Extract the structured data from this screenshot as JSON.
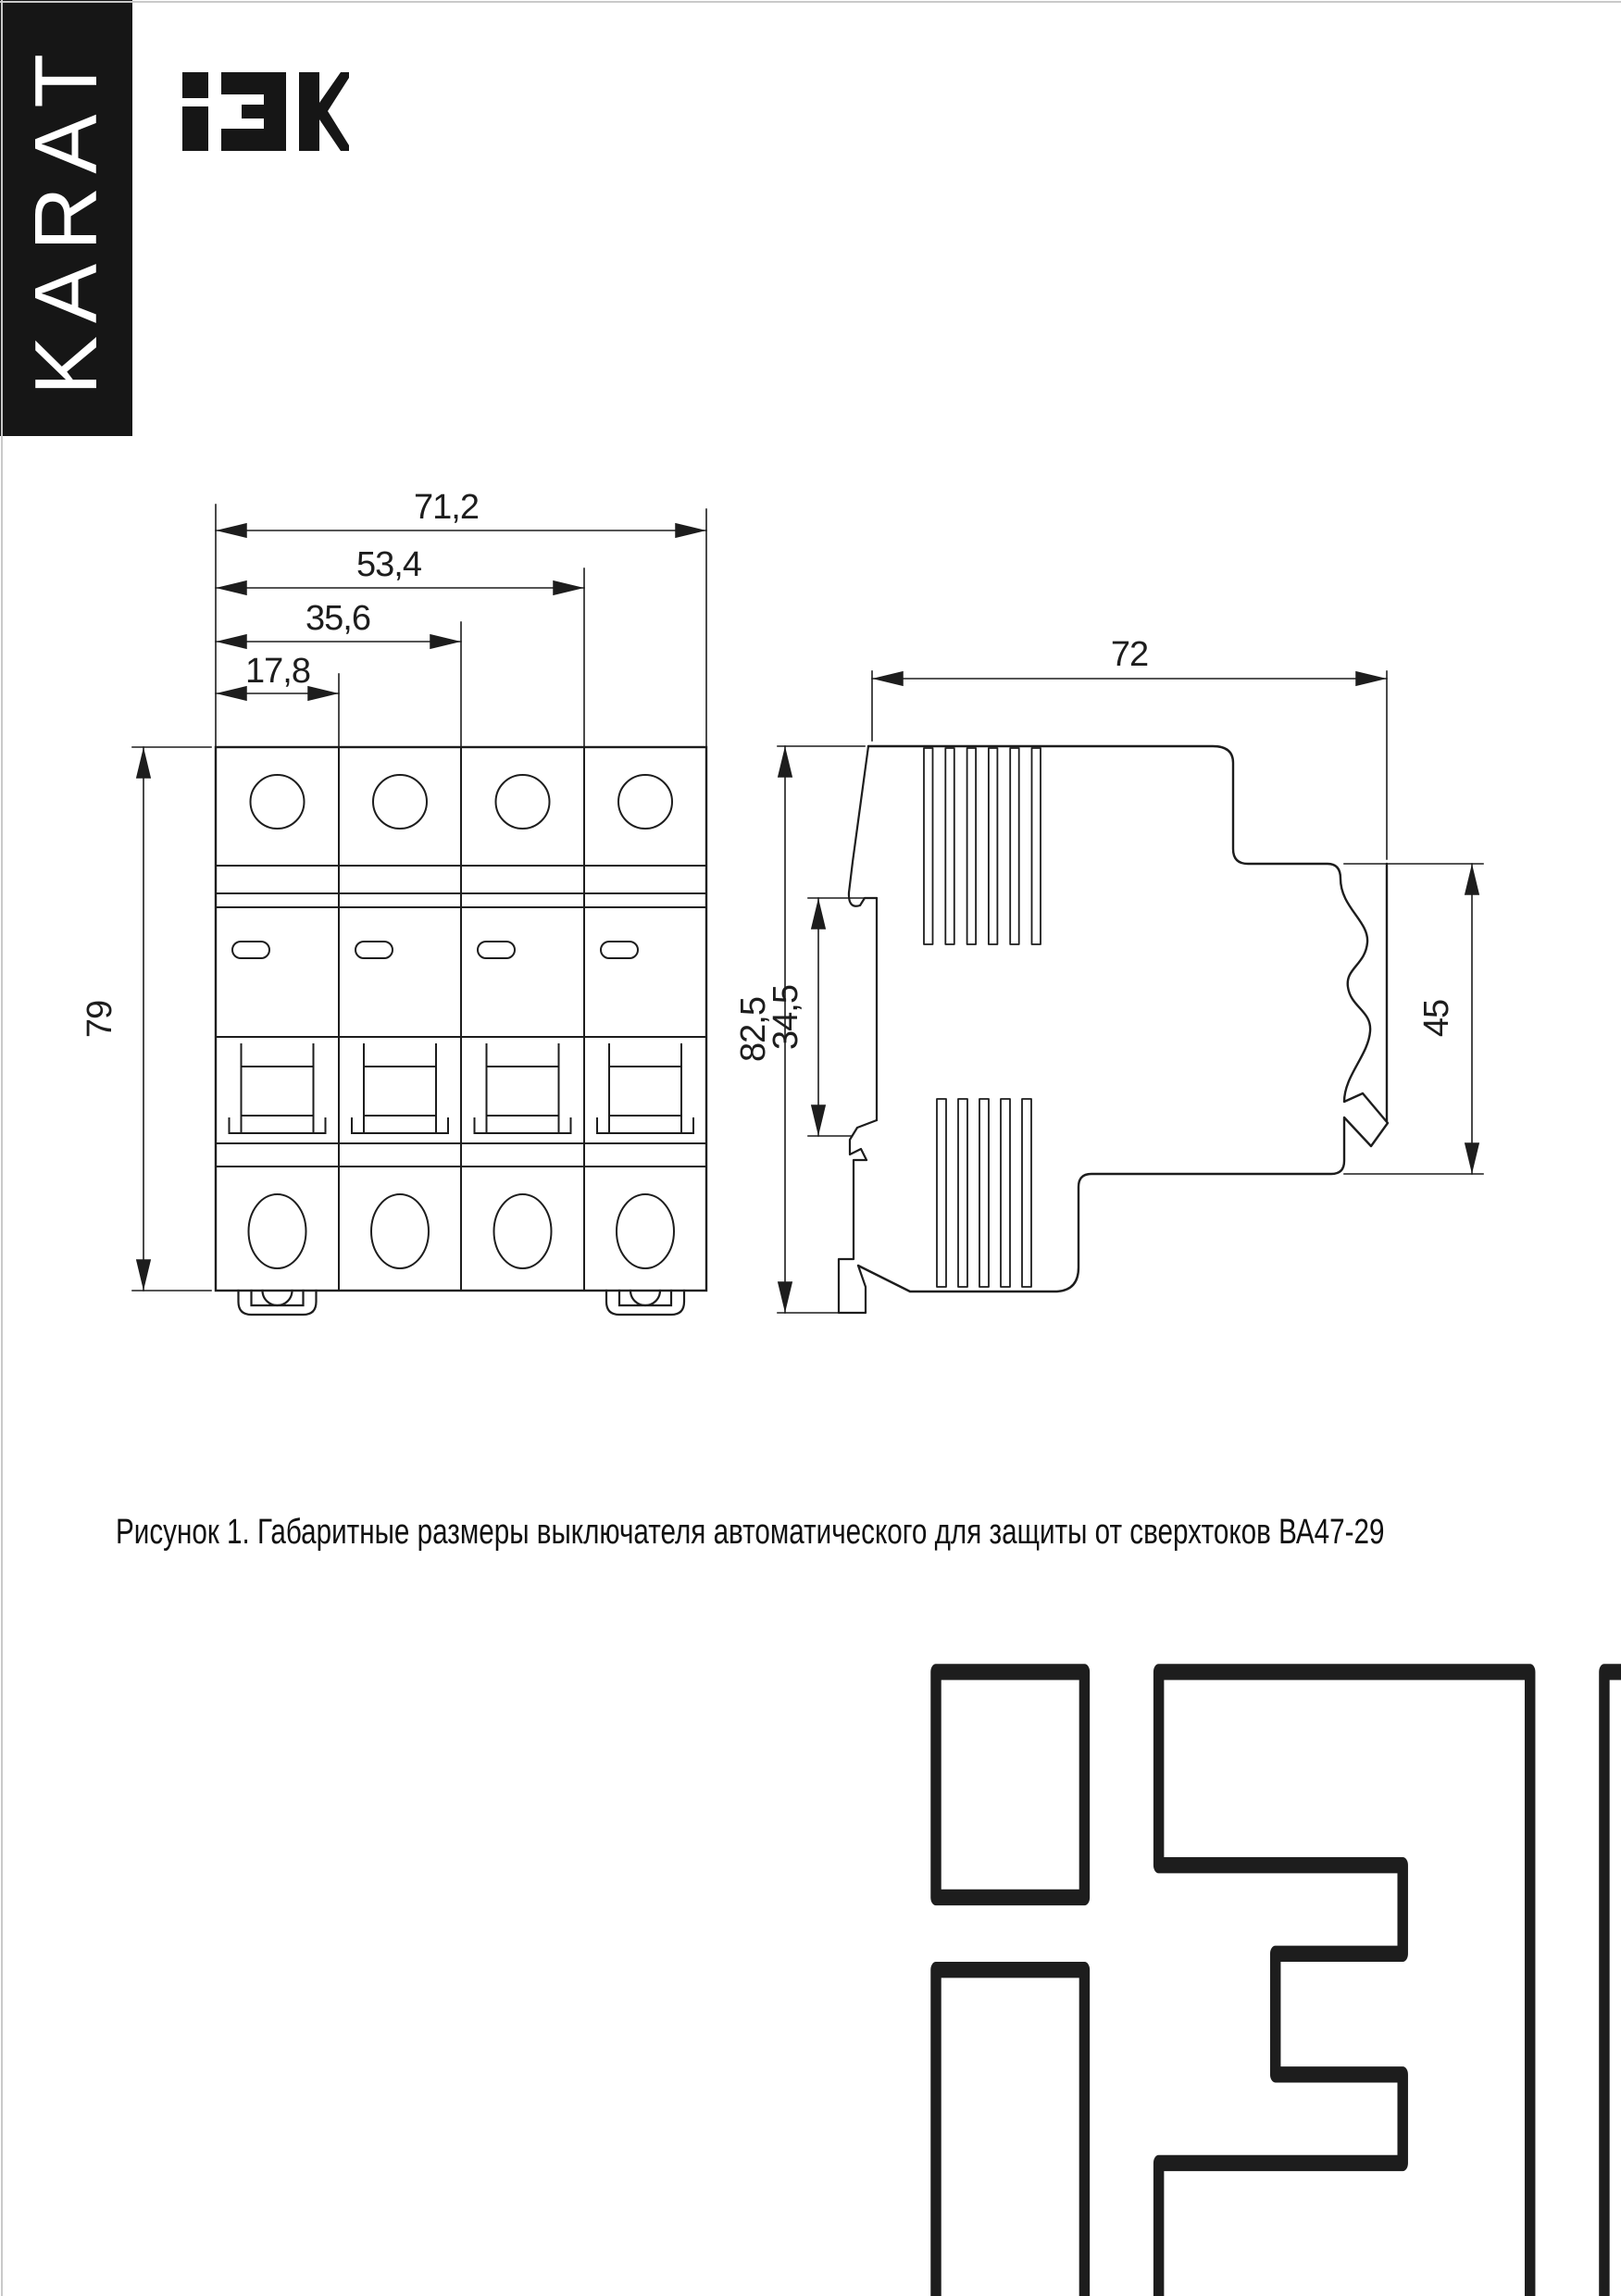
{
  "banner": {
    "text": "KARAT"
  },
  "logo": {
    "glyphs": "iEK"
  },
  "figure": {
    "caption": "Рисунок 1. Габаритные размеры выключателя автоматического для защиты от сверхтоков ВА47-29",
    "front_view": {
      "dim_width_total": "71,2",
      "dim_width_3_modules": "53,4",
      "dim_width_2_modules": "35,6",
      "dim_width_1_module": "17,8",
      "dim_height": "79"
    },
    "side_view": {
      "dim_depth": "72",
      "dim_height_total": "82,5",
      "dim_rail_channel": "34,5",
      "dim_recess_height": "45"
    }
  },
  "colors": {
    "ink": "#1d1d1d",
    "paper": "#ffffff",
    "banner_bg": "#161616",
    "edge_artifact": "#c9c9c9"
  }
}
